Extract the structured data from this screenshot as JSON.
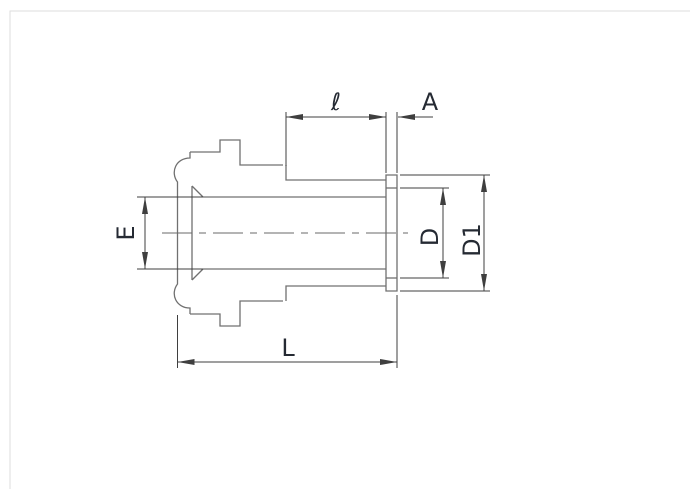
{
  "figure": {
    "kind": "technical-dimension-drawing",
    "labels": {
      "tube_length": "ℓ",
      "sleeve_width": "A",
      "socket_bore": "E",
      "tube_od": "D",
      "sleeve_od": "D1",
      "overall_length": "L"
    },
    "colors": {
      "background": "#ffffff",
      "part_outline": "#707070",
      "dimension_lines": "#3f3f3f",
      "label_text": "#252a33"
    }
  }
}
